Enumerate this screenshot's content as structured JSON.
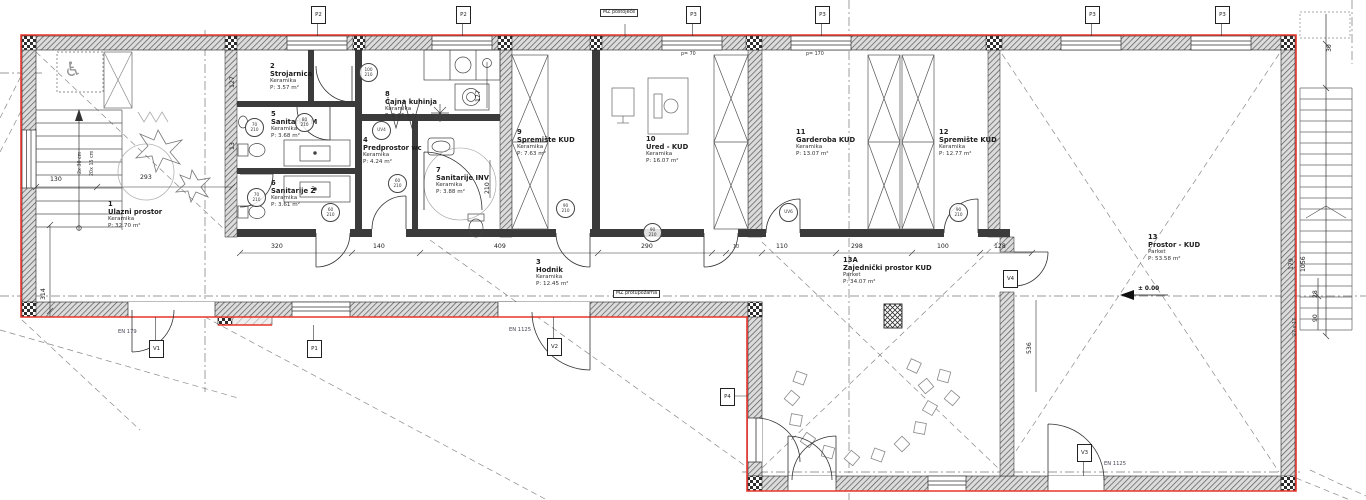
{
  "plan": {
    "rooms": [
      {
        "num": "1",
        "name": "Ulazni prostor",
        "material": "Keramika",
        "area": "P: 32.70 m²"
      },
      {
        "num": "2",
        "name": "Strojarnica",
        "material": "Keramika",
        "area": "P: 3.57 m²"
      },
      {
        "num": "3",
        "name": "Hodnik",
        "material": "Keramika",
        "area": "P: 12.45 m²"
      },
      {
        "num": "4",
        "name": "Predprostor wc",
        "material": "Keramika",
        "area": "P: 4.24 m²"
      },
      {
        "num": "5",
        "name": "Sanitarije M",
        "material": "Keramika",
        "area": "P: 3.68 m²"
      },
      {
        "num": "6",
        "name": "Sanitarije Ž",
        "material": "Keramika",
        "area": "P: 3.61 m²"
      },
      {
        "num": "7",
        "name": "Sanitarije INV",
        "material": "Keramika",
        "area": "P: 3.88 m²"
      },
      {
        "num": "8",
        "name": "Čajna kuhinja",
        "material": "Keramika",
        "area": "P: 5.26 m²"
      },
      {
        "num": "9",
        "name": "Spremište KUD",
        "material": "Keramika",
        "area": "P: 7.63 m²"
      },
      {
        "num": "10",
        "name": "Ured - KUD",
        "material": "Keramika",
        "area": "P: 16.07 m²"
      },
      {
        "num": "11",
        "name": "Garderoba KUD",
        "material": "Keramika",
        "area": "P: 13.07 m²"
      },
      {
        "num": "12",
        "name": "Spremište KUD",
        "material": "Keramika",
        "area": "P: 12.77 m²"
      },
      {
        "num": "13",
        "name": "Prostor - KUD",
        "material": "Parket",
        "area": "P: 53.58 m²"
      },
      {
        "num": "13A",
        "name": "Zajednički prostor KUD",
        "material": "Parket",
        "area": "P: 34.07 m²"
      }
    ],
    "dims": [
      "130",
      "293",
      "320",
      "140",
      "409",
      "290",
      "10",
      "110",
      "298",
      "100",
      "128",
      "314",
      "127",
      "13",
      "177",
      "210",
      "536",
      "179",
      "1056",
      "28",
      "90",
      "30",
      "27 x 17",
      "20x 15 cm",
      "2x 30 cm",
      "p= 70",
      "p= 170"
    ],
    "markers": [
      {
        "label": "P2"
      },
      {
        "label": "P2"
      },
      {
        "label": "P3"
      },
      {
        "label": "P3"
      },
      {
        "label": "P3"
      },
      {
        "label": "P3"
      },
      {
        "label": "V1"
      },
      {
        "label": "P1"
      },
      {
        "label": "V2"
      },
      {
        "label": "V3"
      },
      {
        "label": "V4"
      },
      {
        "label": "P4"
      }
    ],
    "tags": [
      "70\n210",
      "80\n210",
      "70\n210",
      "60\n210",
      "UV4",
      "60\n210",
      "100\n210",
      "90\n210",
      "90\n210",
      "UV6",
      "90\n210"
    ],
    "notes": {
      "en179": "EN 179",
      "en1125_a": "EN 1125",
      "en1125_b": "EN 1125",
      "mz_top": "MZ postojeće",
      "mz_mid": "MZ protupožarna",
      "level": "± 0.00"
    },
    "icons": {
      "wheelchair": "♿"
    },
    "colors": {
      "accent_red": "#e8352a",
      "wall": "#3b3b3b"
    }
  }
}
